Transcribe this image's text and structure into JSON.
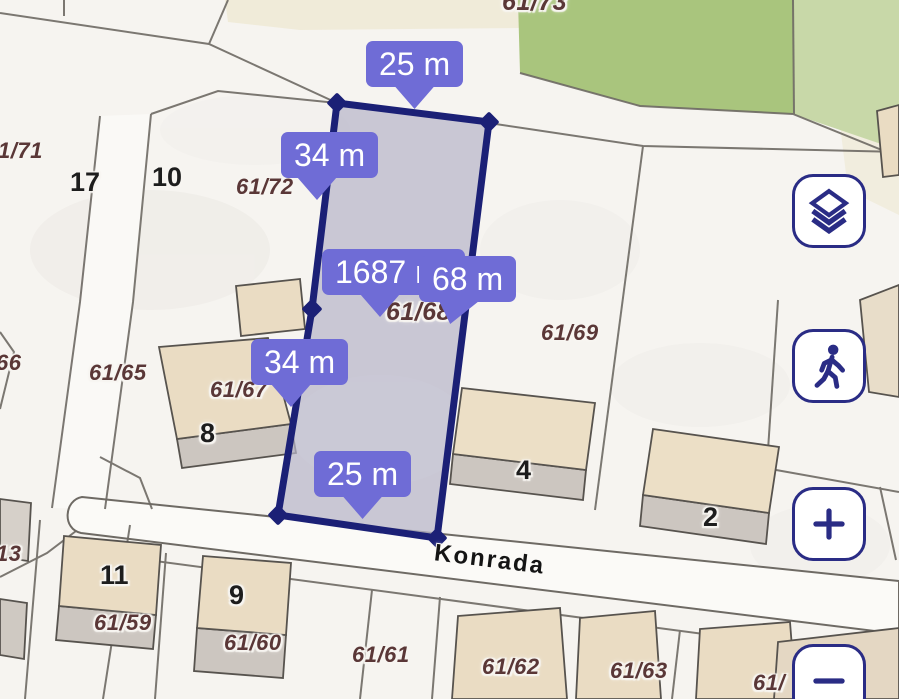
{
  "street": {
    "name": "Konrada"
  },
  "plot": {
    "parcel_number": "61/68",
    "area": "1687 m²",
    "measurements": {
      "top_width": "25 m",
      "left_upper": "34 m",
      "left_lower": "34 m",
      "right_side": "68 m",
      "bottom_width": "25 m"
    }
  },
  "parcel_labels": {
    "p61_73": "61/73",
    "p1_71": "1/71",
    "p61_72": "61/72",
    "p61_69": "61/69",
    "p66": "66",
    "p61_65": "61/65",
    "p61_67": "61/67",
    "p13": "13",
    "p61_59": "61/59",
    "p61_60": "61/60",
    "p61_61": "61/61",
    "p61_62": "61/62",
    "p61_63": "61/63",
    "p61_cut": "61/"
  },
  "house_numbers": {
    "h17": "17",
    "h10": "10",
    "h8": "8",
    "h4": "4",
    "h2": "2",
    "h11": "11",
    "h9": "9"
  },
  "controls": {
    "layers_icon": "layers-stack-icon",
    "walk_icon": "walking-person-icon",
    "zoom_in_icon": "plus-icon",
    "zoom_out_icon": "minus-icon"
  },
  "colors": {
    "measurement_label_bg": "#6f6cd6",
    "measurement_label_text": "#ffffff",
    "plot_outline": "#1b2076",
    "plot_fill": "#b7b5c9",
    "parcel_text": "#5a3737",
    "house_number_text": "#1d1d1d",
    "control_icon": "#2a2c85",
    "green_dark": "#a9c57d",
    "green_light": "#c8d8a8",
    "building_fill": "#eadcc3",
    "building_base_fill": "#ccc6c0",
    "road_fill": "#fbfaf7",
    "boundary_line": "#6e6a64",
    "background": "#f6f4f0"
  }
}
